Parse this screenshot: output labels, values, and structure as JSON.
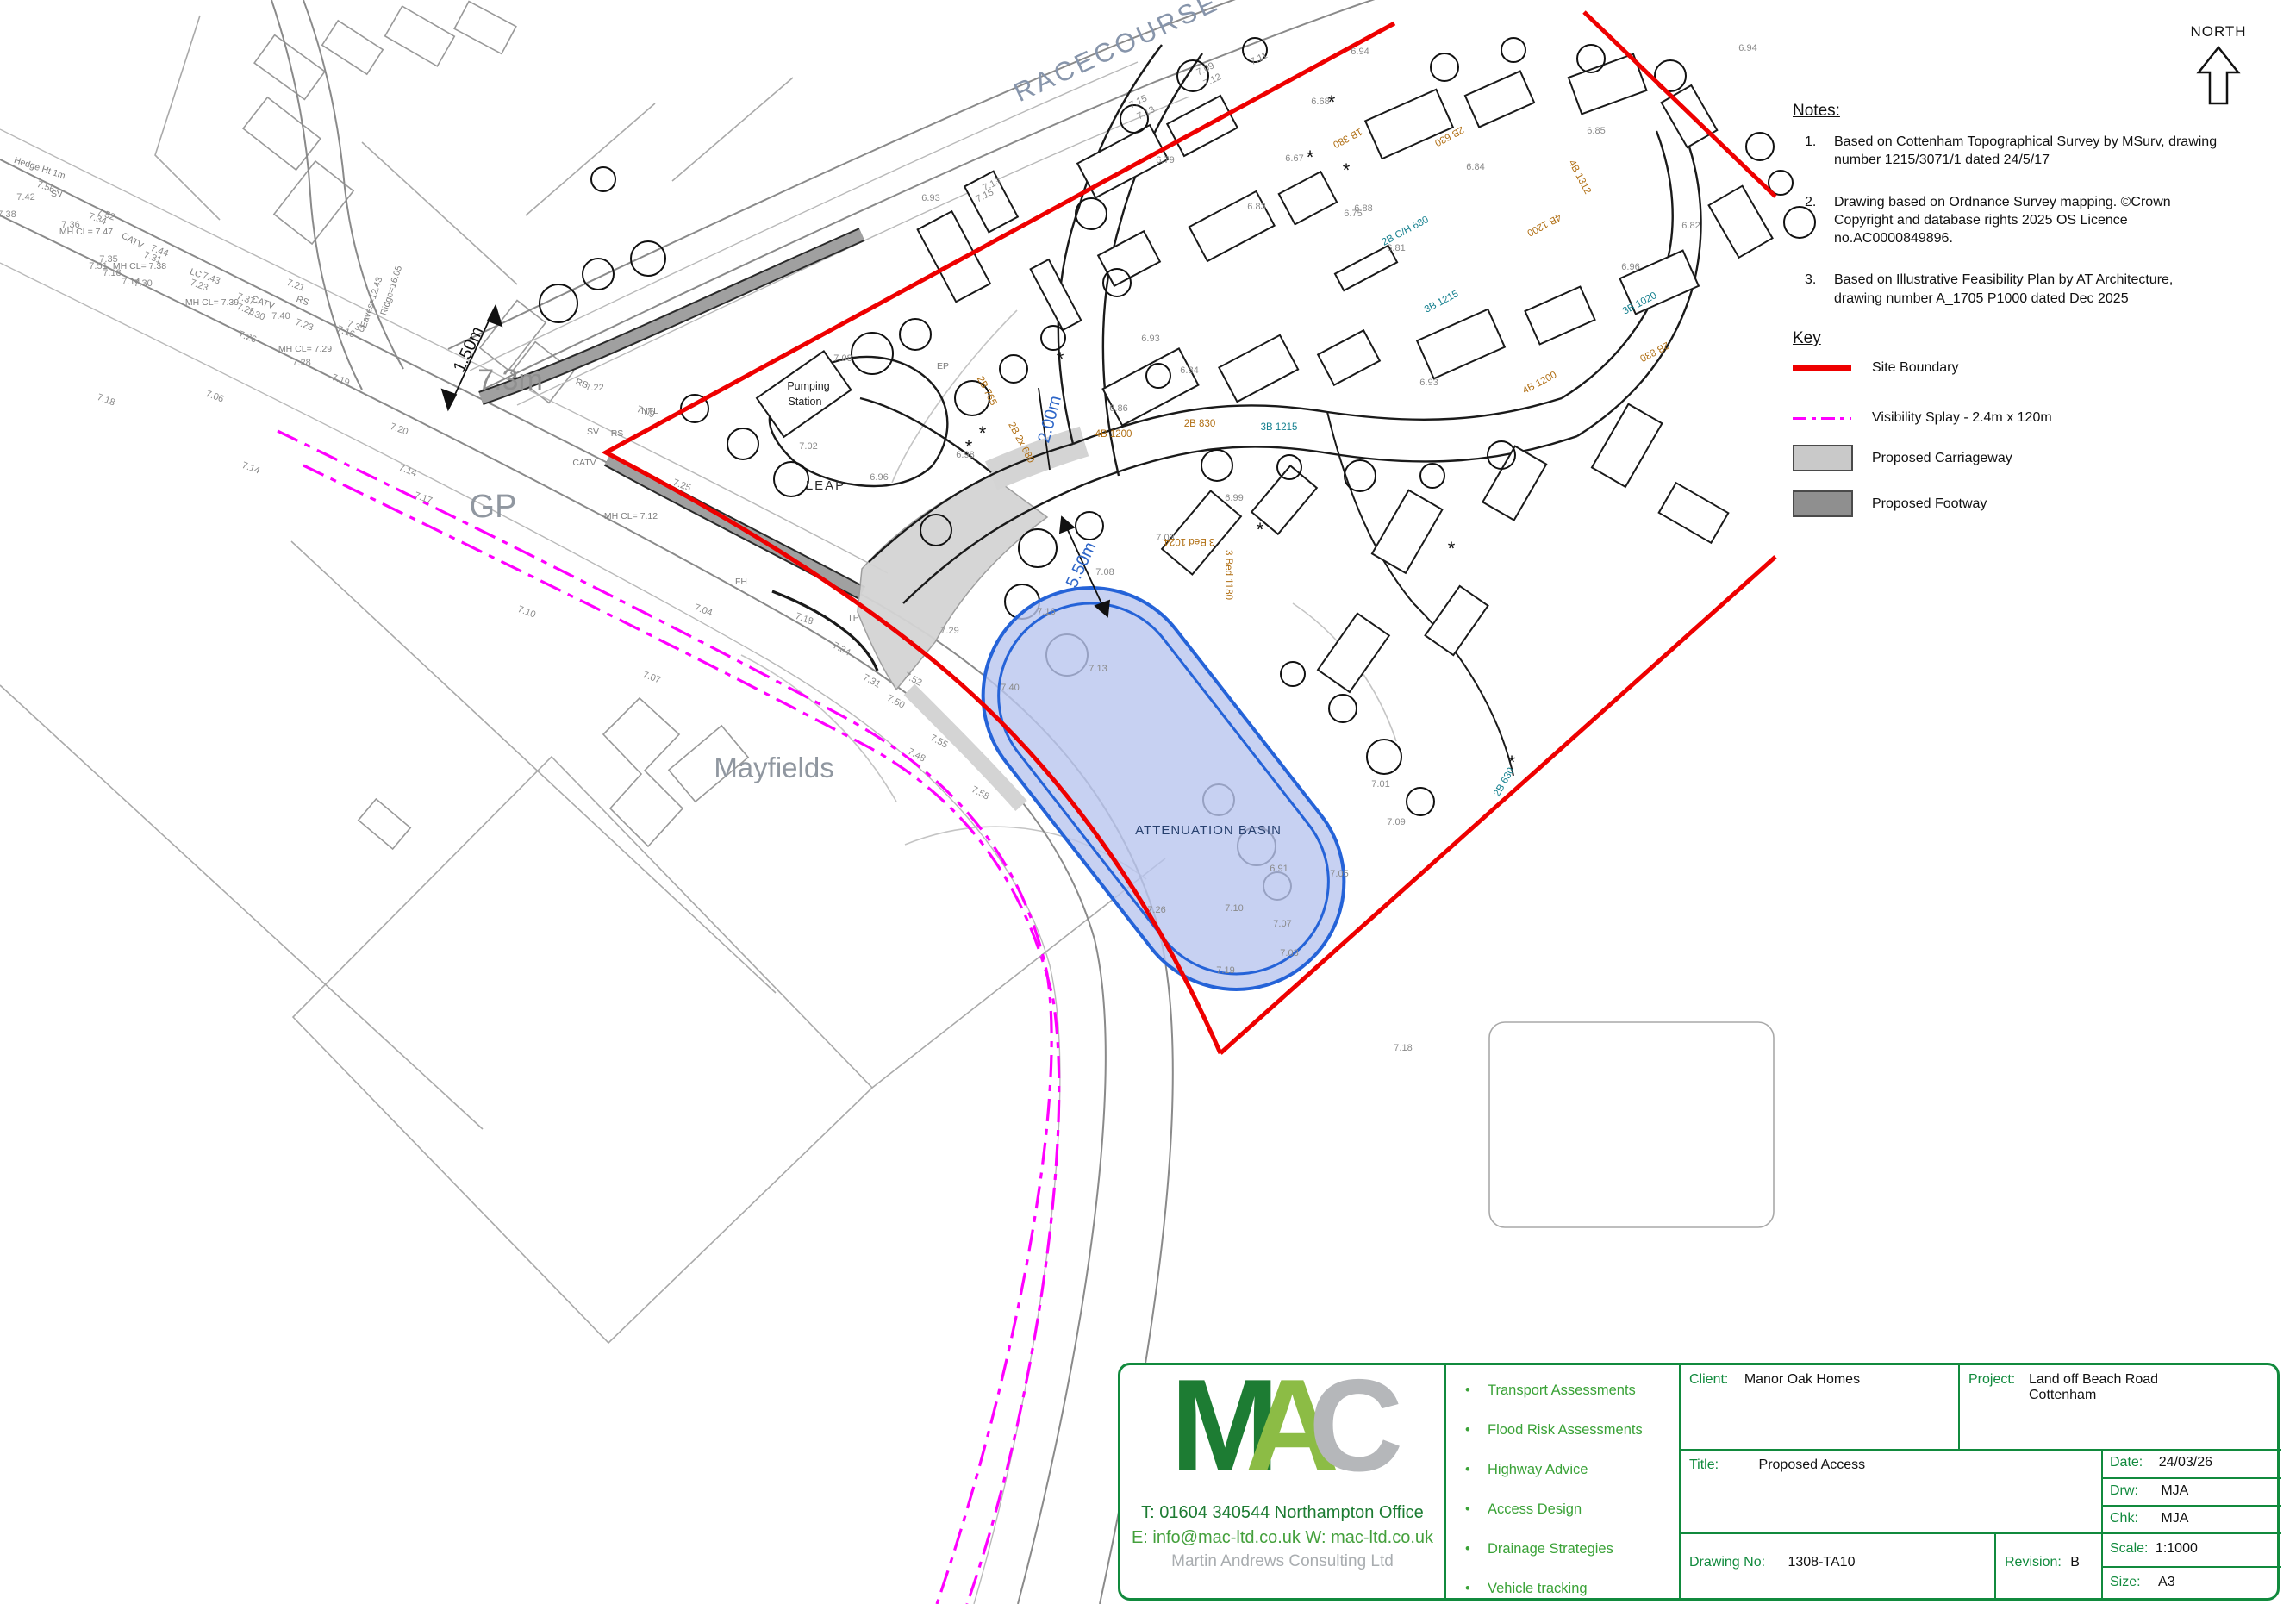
{
  "north": {
    "label": "NORTH"
  },
  "notes": {
    "heading": "Notes:",
    "numbers": [
      "1.",
      "2.",
      "3."
    ],
    "items": [
      "Based on Cottenham Topographical Survey by MSurv, drawing number 1215/3071/1 dated 24/5/17",
      "Drawing based on Ordnance Survey mapping. ©Crown Copyright and database rights 2025 OS Licence no.AC0000849896.",
      "Based on Illustrative Feasibility Plan by AT Architecture, drawing number A_1705 P1000 dated Dec 2025"
    ]
  },
  "key": {
    "heading": "Key",
    "items": [
      {
        "label": "Site Boundary",
        "swatch": "site-boundary",
        "color": "#ee0000"
      },
      {
        "label": "Visibility Splay - 2.4m x 120m",
        "swatch": "visibility-splay",
        "color": "#ff00ff"
      },
      {
        "label": "Proposed Carriageway",
        "swatch": "carriageway",
        "color": "#c9c9c9"
      },
      {
        "label": "Proposed Footway",
        "swatch": "footway",
        "color": "#8f8f8f"
      }
    ]
  },
  "title_block": {
    "logo": {
      "letters": [
        "M",
        "A",
        "C"
      ],
      "phone_line": "T: 01604 340544  Northampton Office",
      "email_line": "E: info@mac-ltd.co.uk   W: mac-ltd.co.uk",
      "company": "Martin Andrews Consulting Ltd"
    },
    "services": [
      "Transport Assessments",
      "Flood Risk Assessments",
      "Highway Advice",
      "Access Design",
      "Drainage Strategies",
      "Vehicle tracking"
    ],
    "bullet": "•",
    "fields": {
      "client_label": "Client:",
      "client": "Manor Oak Homes",
      "project_label": "Project:",
      "project_line1": "Land off Beach Road",
      "project_line2": "Cottenham",
      "title_label": "Title:",
      "title": "Proposed Access",
      "drawing_no_label": "Drawing No:",
      "drawing_no": "1308-TA10",
      "revision_label": "Revision:",
      "revision": "B",
      "date_label": "Date:",
      "date": "24/03/26",
      "drw_label": "Drw:",
      "drw": "MJA",
      "chk_label": "Chk:",
      "chk": "MJA",
      "scale_label": "Scale:",
      "scale": "1:1000",
      "size_label": "Size:",
      "size": "A3"
    }
  },
  "map": {
    "annotations": [
      [
        "RACECOURSE",
        1300,
        64,
        -25,
        "street"
      ],
      [
        "GP",
        572,
        600,
        0,
        "big36"
      ],
      [
        "Mayfields",
        898,
        902,
        0,
        "big32"
      ],
      [
        "7.3m",
        592,
        452,
        0,
        "big34"
      ],
      [
        "1.50m",
        549,
        408,
        -65,
        "dimblack"
      ],
      [
        "2.00m",
        1224,
        488,
        -75,
        "dimblue"
      ],
      [
        "5.50m",
        1260,
        658,
        -65,
        "dimblue"
      ],
      [
        "LEAP",
        958,
        568,
        0,
        "leap"
      ],
      [
        "Pumping",
        938,
        452,
        0,
        "pump"
      ],
      [
        "Station",
        934,
        470,
        0,
        "pump"
      ],
      [
        "ATTENUATION BASIN",
        1402,
        968,
        0,
        "basin"
      ],
      [
        "NORTH",
        2574,
        42,
        0,
        "north16"
      ],
      [
        "Hedge Ht 1m",
        45,
        198,
        18,
        "survey"
      ],
      [
        "MH CL= 7.47",
        100,
        272,
        0,
        "survey"
      ],
      [
        "MH CL= 7.38",
        162,
        312,
        0,
        "survey"
      ],
      [
        "MH CL= 7.39",
        246,
        354,
        0,
        "survey"
      ],
      [
        "MH CL= 7.29",
        354,
        408,
        0,
        "survey"
      ],
      [
        "MH CL= 7.12",
        732,
        602,
        0,
        "survey"
      ],
      [
        "CATV",
        152,
        282,
        30,
        "survey"
      ],
      [
        "CATV",
        304,
        354,
        20,
        "survey"
      ],
      [
        "CATV",
        678,
        540,
        0,
        "survey"
      ],
      [
        "SV",
        66,
        228,
        0,
        "survey"
      ],
      [
        "LC",
        226,
        320,
        20,
        "survey"
      ],
      [
        "RS",
        350,
        352,
        20,
        "survey"
      ],
      [
        "RS",
        674,
        448,
        20,
        "survey"
      ],
      [
        "NTL",
        754,
        480,
        0,
        "survey"
      ],
      [
        "SV",
        688,
        504,
        0,
        "survey"
      ],
      [
        "RS",
        716,
        506,
        0,
        "survey"
      ],
      [
        "FH",
        860,
        678,
        0,
        "survey"
      ],
      [
        "TP",
        990,
        720,
        0,
        "survey"
      ],
      [
        "EP",
        1094,
        428,
        0,
        "survey"
      ],
      [
        "Eaves=12.43",
        434,
        352,
        -72,
        "survey"
      ],
      [
        "Ridge=16.05",
        457,
        338,
        -72,
        "survey"
      ],
      [
        "7.56",
        52,
        220,
        20,
        "spot"
      ],
      [
        "7.42",
        30,
        232,
        0,
        "spot"
      ],
      [
        "7.38",
        8,
        252,
        0,
        "spot"
      ],
      [
        "7.52",
        122,
        252,
        20,
        "spot"
      ],
      [
        "7.36",
        82,
        264,
        0,
        "spot"
      ],
      [
        "7.34",
        112,
        257,
        20,
        "spot"
      ],
      [
        "7.35",
        126,
        304,
        0,
        "spot"
      ],
      [
        "7.51",
        114,
        312,
        0,
        "spot"
      ],
      [
        "7.30",
        166,
        332,
        0,
        "spot"
      ],
      [
        "7.44",
        184,
        294,
        20,
        "spot"
      ],
      [
        "7.31",
        176,
        302,
        20,
        "spot"
      ],
      [
        "7.43",
        244,
        326,
        20,
        "spot"
      ],
      [
        "7.23",
        230,
        334,
        20,
        "spot"
      ],
      [
        "7.37",
        284,
        350,
        20,
        "spot"
      ],
      [
        "7.25",
        284,
        362,
        20,
        "spot"
      ],
      [
        "7.30",
        296,
        368,
        20,
        "spot"
      ],
      [
        "7.40",
        326,
        370,
        0,
        "spot"
      ],
      [
        "7.23",
        352,
        380,
        20,
        "spot"
      ],
      [
        "7.26",
        286,
        394,
        20,
        "spot"
      ],
      [
        "7.28",
        350,
        424,
        0,
        "spot"
      ],
      [
        "7.19",
        394,
        444,
        20,
        "spot"
      ],
      [
        "7.16",
        400,
        388,
        20,
        "spot"
      ],
      [
        "7.35",
        412,
        382,
        20,
        "spot"
      ],
      [
        "7.21",
        342,
        334,
        20,
        "spot"
      ],
      [
        "7.14",
        152,
        330,
        0,
        "spot"
      ],
      [
        "7.18",
        130,
        320,
        0,
        "spot"
      ],
      [
        "7.15",
        1322,
        121,
        -26,
        "spot"
      ],
      [
        "7.13",
        1331,
        134,
        -26,
        "spot"
      ],
      [
        "7.09",
        1400,
        83,
        -26,
        "spot"
      ],
      [
        "7.12",
        1408,
        96,
        -26,
        "spot"
      ],
      [
        "7.13",
        1152,
        217,
        -26,
        "spot"
      ],
      [
        "7.15",
        1144,
        230,
        -26,
        "spot"
      ],
      [
        "7.11",
        1462,
        71,
        -26,
        "spot"
      ],
      [
        "6.94",
        1578,
        63,
        0,
        "spot"
      ],
      [
        "6.68",
        1532,
        121,
        0,
        "spot"
      ],
      [
        "6.83",
        1458,
        243,
        0,
        "spot"
      ],
      [
        "6.79",
        1352,
        189,
        0,
        "spot"
      ],
      [
        "6.67",
        1502,
        187,
        0,
        "spot"
      ],
      [
        "6.94",
        2028,
        59,
        0,
        "spot"
      ],
      [
        "6.93",
        1080,
        233,
        0,
        "spot"
      ],
      [
        "7.08",
        978,
        419,
        0,
        "spot"
      ],
      [
        "7.02",
        938,
        521,
        0,
        "spot"
      ],
      [
        "6.96",
        1020,
        557,
        0,
        "spot"
      ],
      [
        "6.98",
        1120,
        531,
        0,
        "spot"
      ],
      [
        "6.93",
        1335,
        396,
        0,
        "spot"
      ],
      [
        "6.86",
        1298,
        477,
        0,
        "spot"
      ],
      [
        "6.84",
        1380,
        433,
        0,
        "spot"
      ],
      [
        "6.88",
        1582,
        245,
        0,
        "spot"
      ],
      [
        "6.75",
        1570,
        251,
        0,
        "spot"
      ],
      [
        "6.81",
        1620,
        291,
        0,
        "spot"
      ],
      [
        "6.82",
        1962,
        265,
        0,
        "spot"
      ],
      [
        "6.85",
        1852,
        155,
        0,
        "spot"
      ],
      [
        "6.84",
        1712,
        197,
        0,
        "spot"
      ],
      [
        "6.93",
        1658,
        447,
        0,
        "spot"
      ],
      [
        "6.96",
        1892,
        313,
        0,
        "spot"
      ],
      [
        "6.99",
        1432,
        581,
        0,
        "spot"
      ],
      [
        "7.03",
        1352,
        627,
        0,
        "spot"
      ],
      [
        "7.08",
        1282,
        667,
        0,
        "spot"
      ],
      [
        "6.91",
        1484,
        1011,
        0,
        "spot"
      ],
      [
        "7.10",
        1432,
        1057,
        0,
        "spot"
      ],
      [
        "7.26",
        1342,
        1059,
        0,
        "spot"
      ],
      [
        "7.01",
        1602,
        913,
        0,
        "spot"
      ],
      [
        "7.09",
        1620,
        957,
        0,
        "spot"
      ],
      [
        "7.05",
        1554,
        1017,
        0,
        "spot"
      ],
      [
        "7.07",
        1488,
        1075,
        0,
        "spot"
      ],
      [
        "7.03",
        1496,
        1109,
        0,
        "spot"
      ],
      [
        "7.19",
        1422,
        1129,
        0,
        "spot"
      ],
      [
        "7.18",
        1628,
        1219,
        0,
        "spot"
      ],
      [
        "7.16",
        1214,
        713,
        0,
        "spot"
      ],
      [
        "7.13",
        1274,
        779,
        0,
        "spot"
      ],
      [
        "7.40",
        1172,
        801,
        0,
        "spot"
      ],
      [
        "7.29",
        1102,
        735,
        0,
        "spot"
      ],
      [
        "7.18",
        932,
        721,
        20,
        "spot"
      ],
      [
        "7.31",
        1010,
        793,
        28,
        "spot"
      ],
      [
        "7.50",
        1038,
        817,
        28,
        "spot"
      ],
      [
        "7.52",
        1058,
        791,
        28,
        "spot"
      ],
      [
        "7.55",
        1088,
        863,
        28,
        "spot"
      ],
      [
        "7.58",
        1136,
        923,
        28,
        "spot"
      ],
      [
        "7.34",
        975,
        756,
        28,
        "spot"
      ],
      [
        "7.48",
        1062,
        879,
        28,
        "spot"
      ],
      [
        "7.06",
        248,
        463,
        20,
        "spot"
      ],
      [
        "7.07",
        755,
        789,
        20,
        "spot"
      ],
      [
        "7.10",
        610,
        713,
        20,
        "spot"
      ],
      [
        "7.14",
        472,
        549,
        20,
        "spot"
      ],
      [
        "7.14",
        290,
        546,
        20,
        "spot"
      ],
      [
        "7.18",
        122,
        467,
        20,
        "spot"
      ],
      [
        "7.04",
        815,
        711,
        20,
        "spot"
      ],
      [
        "7.17",
        490,
        581,
        20,
        "spot"
      ],
      [
        "7.20",
        462,
        501,
        20,
        "spot"
      ],
      [
        "7.25",
        790,
        566,
        20,
        "spot"
      ],
      [
        "7.22",
        690,
        453,
        0,
        "spot"
      ],
      [
        "7.09",
        748,
        481,
        20,
        "spot"
      ],
      [
        "1B 380",
        1562,
        157,
        152,
        "houseO"
      ],
      [
        "2B 630",
        1680,
        155,
        152,
        "houseO"
      ],
      [
        "2B C/H 680",
        1632,
        271,
        -28,
        "houseT"
      ],
      [
        "3B 1215",
        1674,
        353,
        -28,
        "houseT"
      ],
      [
        "4B 1200",
        1790,
        258,
        152,
        "houseO"
      ],
      [
        "4B 1312",
        1830,
        207,
        62,
        "houseO"
      ],
      [
        "3B 1020",
        1904,
        355,
        -28,
        "houseT"
      ],
      [
        "2B 830",
        1918,
        405,
        152,
        "houseO"
      ],
      [
        "4B 1200",
        1788,
        447,
        -28,
        "houseO"
      ],
      [
        "2B 830",
        1392,
        495,
        0,
        "houseO"
      ],
      [
        "3B 1215",
        1484,
        499,
        0,
        "houseT"
      ],
      [
        "4B 1200",
        1292,
        507,
        0,
        "houseO"
      ],
      [
        "2B 2x 680",
        1182,
        515,
        62,
        "houseO"
      ],
      [
        "2B 765",
        1142,
        455,
        62,
        "houseO"
      ],
      [
        "3 Bed 1024",
        1380,
        625,
        180,
        "houseO"
      ],
      [
        "3 Bed 1180",
        1422,
        667,
        90,
        "houseO"
      ],
      [
        "2B 630",
        1748,
        909,
        -60,
        "houseT"
      ],
      [
        "*",
        1545,
        126,
        0,
        "star"
      ],
      [
        "*",
        1520,
        190,
        0,
        "star"
      ],
      [
        "*",
        1562,
        205,
        0,
        "star"
      ],
      [
        "*",
        1140,
        510,
        0,
        "star"
      ],
      [
        "*",
        1124,
        526,
        0,
        "star"
      ],
      [
        "*",
        1462,
        622,
        0,
        "star"
      ],
      [
        "*",
        1230,
        424,
        0,
        "star"
      ],
      [
        "*",
        1684,
        644,
        0,
        "star"
      ],
      [
        "*",
        1754,
        892,
        0,
        "star"
      ]
    ]
  }
}
